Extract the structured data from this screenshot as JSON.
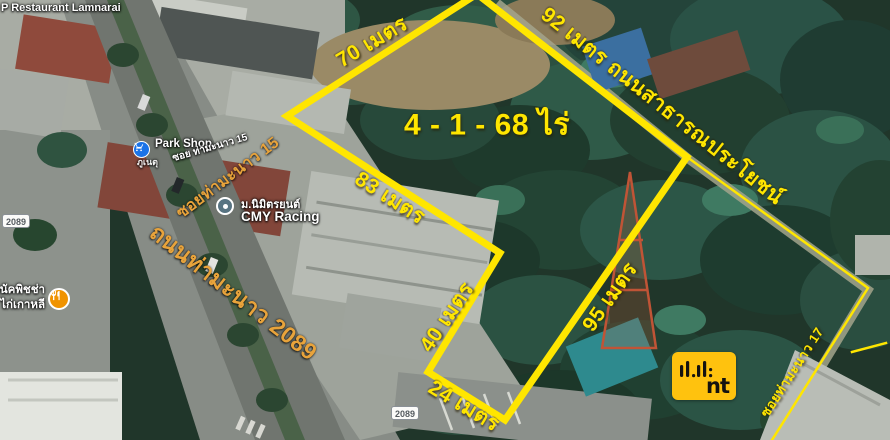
{
  "annotations": {
    "area_label": "4 - 1 - 68 ไร่",
    "edge_top_left": "70 เมตร",
    "edge_road": "92 เมตร ถนนสาธารณประโยชน์",
    "edge_inner_left": "83 เมตร",
    "edge_west": "40 เมตร",
    "edge_east": "95 เมตร",
    "edge_south": "24 เมตร",
    "soi17_label": "ซอยท่ามะนาว 17"
  },
  "map": {
    "poi_restaurant_top": "P Restaurant Lamnarai",
    "park_shop": "Park Shop",
    "park_shop_sub": "ภูเนตุ",
    "street_soi15_small": "ซอย ท่ามะนาว 15",
    "street_soi15": "ซอยท่ามะนาว 15",
    "street_main": "ถนนท่ามะนาว 2089",
    "cmy_line1": "ม.นิมิตรยนต์",
    "cmy_line2": "CMY Racing",
    "pizza_line1": "กนัคพิชช่า",
    "pizza_line2": "& ไก่เกาหลี",
    "route_badge": "2089"
  },
  "watermark": {
    "logo_text": "nt"
  },
  "colors": {
    "annotation_yellow": "#FFE600",
    "street_label_orange": "#E8A33B",
    "nt_logo_yellow": "#FFC20E",
    "poi_blue": "#1A73E8",
    "poi_orange": "#F09300"
  }
}
